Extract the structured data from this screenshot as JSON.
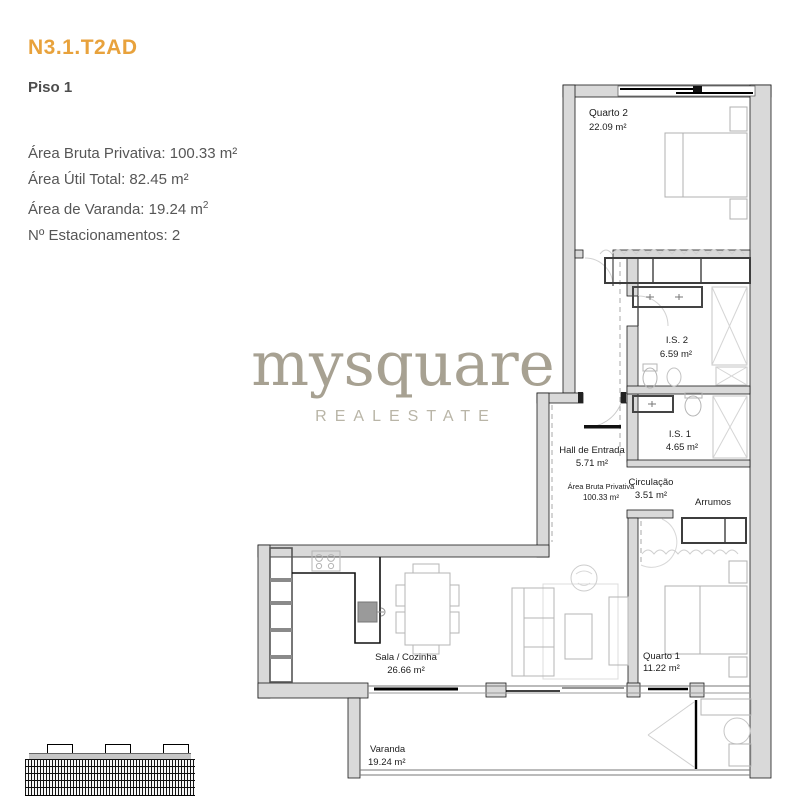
{
  "header": {
    "unit_code": "N3.1.T2AD",
    "floor_label": "Piso 1"
  },
  "details": {
    "area_bruta": "Área Bruta Privativa: 100.33 m²",
    "area_util": "Área Útil Total: 82.45 m²",
    "area_varanda_text": "Área de Varanda: 19.24 m",
    "area_varanda_sup": "2",
    "estacionamentos": "Nº Estacionamentos: 2"
  },
  "logo": {
    "brand": "mysquare",
    "tagline": "REALESTATE"
  },
  "floorplan": {
    "rooms": [
      {
        "name": "Quarto 2",
        "area": "22.09 m²"
      },
      {
        "name": "I.S. 2",
        "area": "6.59 m²"
      },
      {
        "name": "I.S. 1",
        "area": "4.65 m²"
      },
      {
        "name": "Hall de Entrada",
        "area": "5.71 m²"
      },
      {
        "name": "Área Bruta Privativa",
        "area": "100.33 m²"
      },
      {
        "name": "Circulação",
        "area": "3.51 m²"
      },
      {
        "name": "Arrumos",
        "area": ""
      },
      {
        "name": "Quarto 1",
        "area": "11.22 m²"
      },
      {
        "name": "Sala / Cozinha",
        "area": "26.66 m²"
      },
      {
        "name": "Varanda",
        "area": "19.24 m²"
      }
    ],
    "colors": {
      "accent_orange": "#E8A23C",
      "body_text": "#565656",
      "logo_brand": "#A7A192",
      "logo_tagline": "#B9B5A7",
      "wall_fill": "#D9D9D9",
      "wall_stroke": "#1A1A1A",
      "furniture_line": "#B5B5B5",
      "fixture_line": "#4A4A4A"
    }
  }
}
